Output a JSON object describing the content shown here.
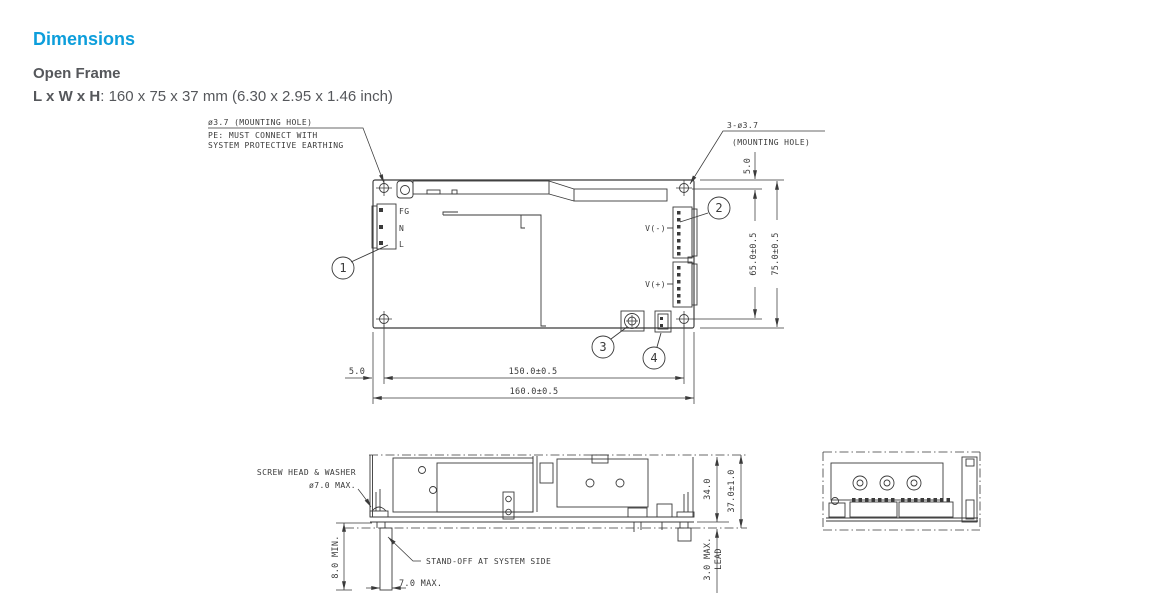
{
  "header": {
    "title": "Dimensions",
    "section": "Open Frame",
    "size_label": "L x W x H",
    "size_value": ": 160 x 75 x 37 mm (6.30 x 2.95 x 1.46 inch)"
  },
  "colors": {
    "accent": "#0d9edb",
    "body_text": "#55575b",
    "line": "#3a3a3a"
  },
  "top_view": {
    "note_left_hole": "ø3.7 (MOUNTING HOLE)",
    "note_pe_1": "PE: MUST CONNECT WITH",
    "note_pe_2": "SYSTEM PROTECTIVE EARTHING",
    "note_right_hole_1": "3-ø3.7",
    "note_right_hole_2": "(MOUNTING HOLE)",
    "pin_labels": {
      "fg": "FG",
      "n": "N",
      "l": "L",
      "v_minus": "V(-)",
      "v_plus": "V(+)"
    },
    "callout_1": "1",
    "callout_2": "2",
    "callout_3": "3",
    "callout_4": "4",
    "dim_top_edge_to_hole": "5.0",
    "dim_hole_to_hole_v": "65.0±0.5",
    "dim_overall_height": "75.0±0.5",
    "dim_left_edge_to_hole": "5.0",
    "dim_hole_to_hole_h": "150.0±0.5",
    "dim_overall_width": "160.0±0.5"
  },
  "side_view": {
    "note_screw_1": "SCREW HEAD & WASHER",
    "note_screw_2": "ø7.0 MAX.",
    "note_standoff": "STAND-OFF AT SYSTEM SIDE",
    "dim_component_height": "34.0",
    "dim_overall_height": "37.0±1.0",
    "dim_standoff_height": "8.0 MIN.",
    "dim_standoff_width": "7.0 MAX.",
    "dim_lead_1": "3.0 MAX.",
    "dim_lead_2": "LEAD"
  }
}
